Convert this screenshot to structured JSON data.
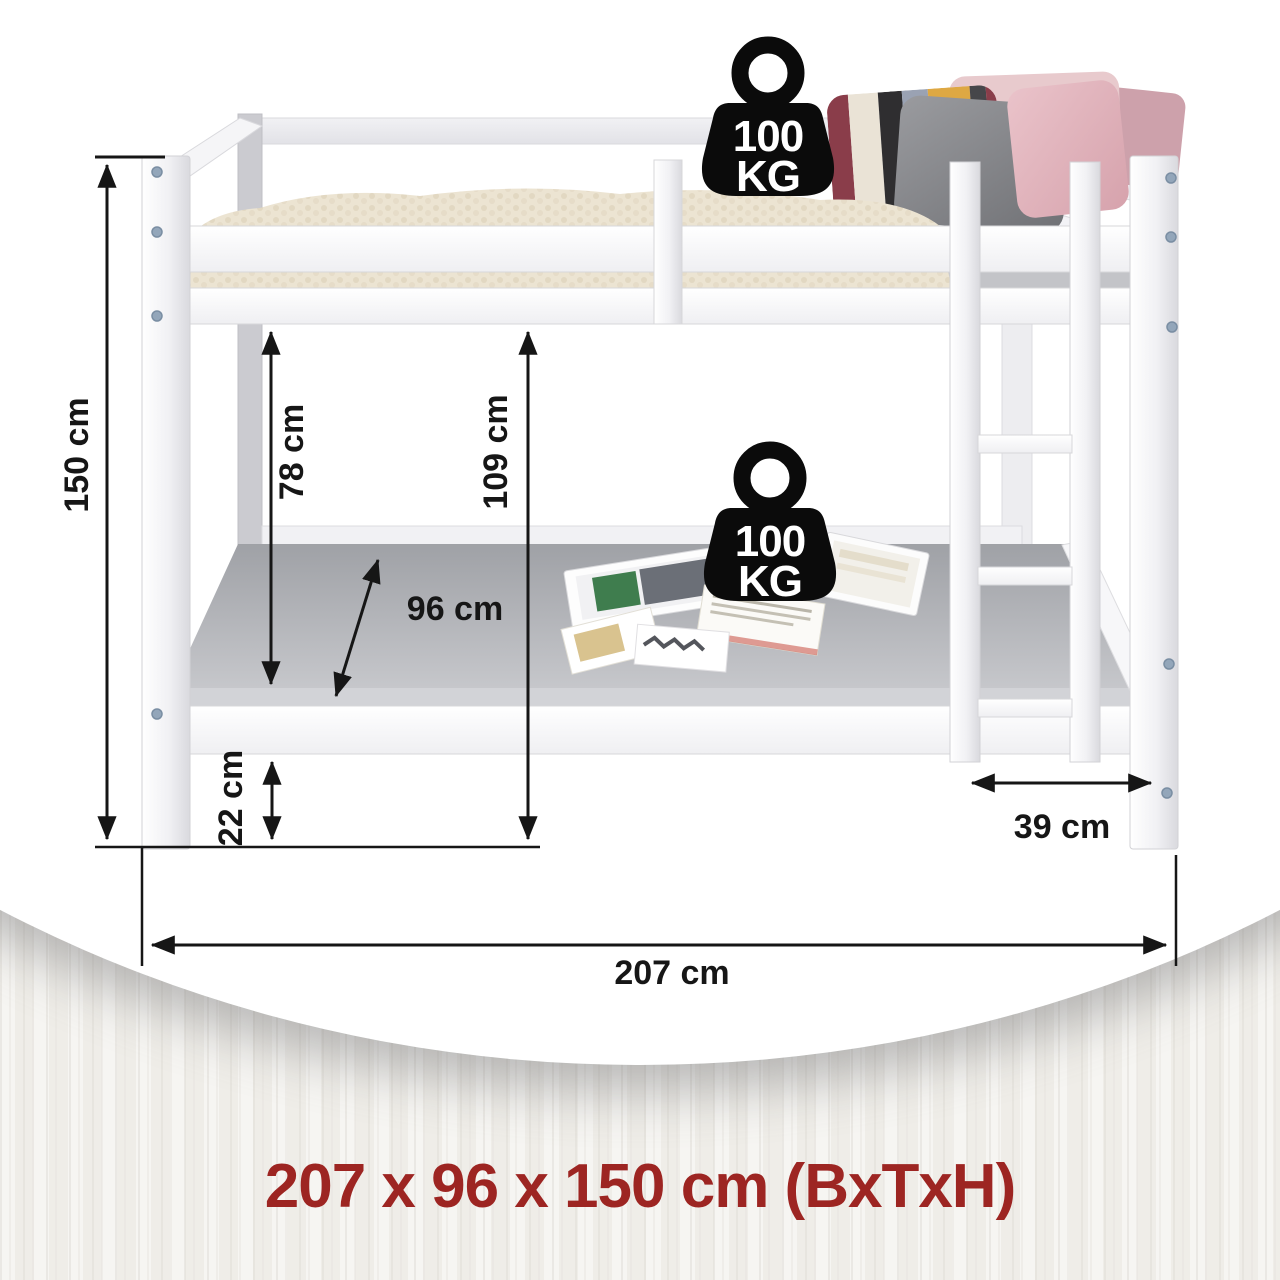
{
  "caption": {
    "text": "207 x 96 x 150 cm (BxTxH)"
  },
  "dimension_labels": {
    "total_height": "150 cm",
    "bunk_clearance": "78 cm",
    "under_top_height": "109 cm",
    "mattress_depth": "96 cm",
    "frame_base_height": "22 cm",
    "ladder_offset": "39 cm",
    "total_width": "207 cm"
  },
  "weight_badges": [
    {
      "icon": "weight-100kg-icon",
      "value": "100",
      "unit": "KG"
    },
    {
      "icon": "weight-100kg-icon",
      "value": "100",
      "unit": "KG"
    }
  ],
  "colors": {
    "caption_red": "#9d2522",
    "dimension_line": "#161616",
    "bed_white": "#ffffff",
    "mattress_gray": "#b8b9bd",
    "blanket_cream": "#ece4d2"
  }
}
